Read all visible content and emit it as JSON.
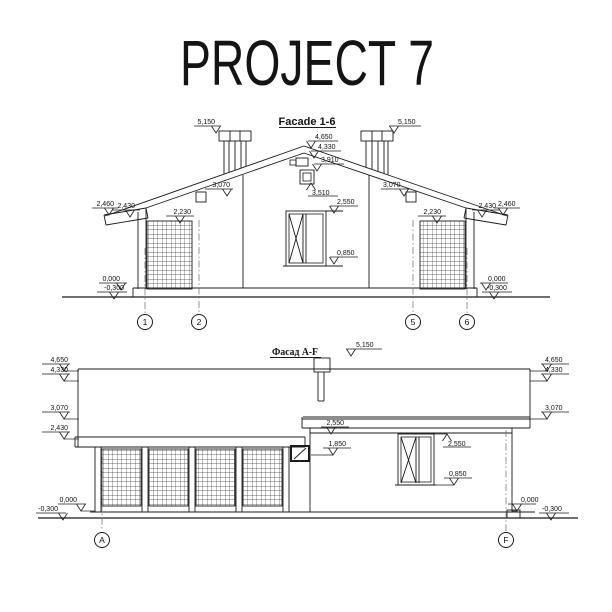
{
  "page": {
    "title": "PROJECT 7"
  },
  "facade1": {
    "title": "Facade 1-6",
    "marks": {
      "chimney_left": "5,150",
      "chimney_right": "5,150",
      "ridge_top": "4,650",
      "ridge": "4,330",
      "ridge_vent": "3,910",
      "gable_window": "3,510",
      "slope_left": "3,070",
      "slope_right": "3,070",
      "eave_outer_left": "2,460",
      "eave_inner_left": "2,430",
      "eave_inner_right": "2,430",
      "eave_outer_right": "2,460",
      "trellis_left": "2,230",
      "trellis_right": "2,230",
      "window_head": "2,550",
      "window_sill": "0,850",
      "ground_left": "0,000",
      "foundation_left": "-0,300",
      "ground_right": "0,000",
      "foundation_right": "-0,300"
    },
    "axes": {
      "one": "1",
      "two": "2",
      "five": "5",
      "six": "6"
    }
  },
  "facade2": {
    "title": "Фасад А-F",
    "marks": {
      "chimney": "5,150",
      "ridge_top_left": "4,650",
      "ridge_left": "4,330",
      "slope_left": "3,070",
      "canopy_left": "2,430",
      "porch_roof": "2,550",
      "porch_window_head": "1,850",
      "window_head": "2,550",
      "window_sill": "0,850",
      "ridge_top_right": "4,650",
      "ridge_right": "4,330",
      "slope_right": "3,070",
      "ground_left": "0,000",
      "foundation_left": "-0,300",
      "ground_right": "0,000",
      "foundation_right": "-0,300"
    },
    "axes": {
      "a": "A",
      "f": "F"
    }
  }
}
